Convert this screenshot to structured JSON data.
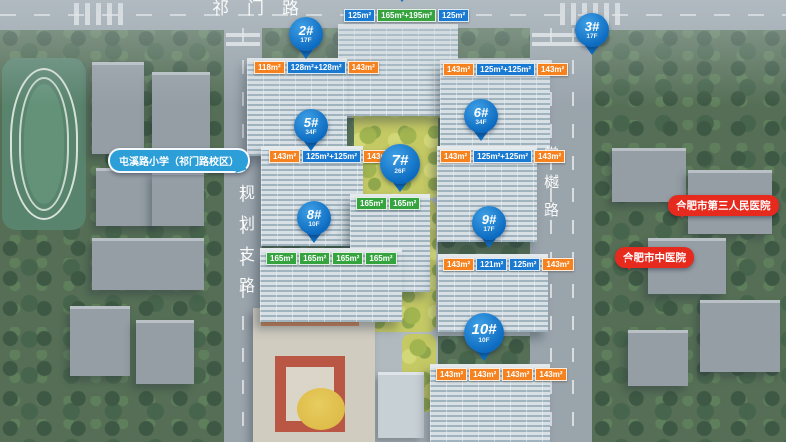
{
  "scene": {
    "type": "residential-masterplan-aerial-render"
  },
  "map": {
    "roads": {
      "top": "祁门路",
      "left": "规划支路",
      "right": "棠樾路"
    },
    "pins": [
      {
        "id": "top-partial",
        "label": "",
        "floors": "",
        "x": 402,
        "y": -40,
        "size": ""
      },
      {
        "id": "2",
        "label": "2#",
        "floors": "17F",
        "x": 306,
        "y": 17,
        "size": ""
      },
      {
        "id": "3",
        "label": "3#",
        "floors": "17F",
        "x": 592,
        "y": 13,
        "size": ""
      },
      {
        "id": "5",
        "label": "5#",
        "floors": "34F",
        "x": 311,
        "y": 109,
        "size": ""
      },
      {
        "id": "6",
        "label": "6#",
        "floors": "34F",
        "x": 481,
        "y": 99,
        "size": ""
      },
      {
        "id": "7",
        "label": "7#",
        "floors": "26F",
        "x": 400,
        "y": 144,
        "size": "lg"
      },
      {
        "id": "8",
        "label": "8#",
        "floors": "10F",
        "x": 314,
        "y": 201,
        "size": ""
      },
      {
        "id": "9",
        "label": "9#",
        "floors": "17F",
        "x": 489,
        "y": 206,
        "size": ""
      },
      {
        "id": "10",
        "label": "10#",
        "floors": "10F",
        "x": 484,
        "y": 313,
        "size": "lg"
      }
    ],
    "tag_rows": [
      {
        "building": "1",
        "x": 344,
        "y": 9,
        "tags": [
          {
            "t": "125m²",
            "c": "blue"
          },
          {
            "t": "165m²+195m²",
            "c": "green"
          },
          {
            "t": "125m²",
            "c": "blue"
          }
        ]
      },
      {
        "building": "2",
        "x": 254,
        "y": 61,
        "tags": [
          {
            "t": "118m²",
            "c": "orange"
          },
          {
            "t": "128m²+128m²",
            "c": "blue"
          },
          {
            "t": "143m²",
            "c": "orange"
          }
        ]
      },
      {
        "building": "3",
        "x": 443,
        "y": 63,
        "tags": [
          {
            "t": "143m²",
            "c": "orange"
          },
          {
            "t": "125m²+125m²",
            "c": "blue"
          },
          {
            "t": "143m²",
            "c": "orange"
          }
        ]
      },
      {
        "building": "5",
        "x": 269,
        "y": 150,
        "tags": [
          {
            "t": "143m²",
            "c": "orange"
          },
          {
            "t": "125m²+125m²",
            "c": "blue"
          },
          {
            "t": "143m²",
            "c": "orange"
          }
        ]
      },
      {
        "building": "6",
        "x": 440,
        "y": 150,
        "tags": [
          {
            "t": "143m²",
            "c": "orange"
          },
          {
            "t": "125m²+125m²",
            "c": "blue"
          },
          {
            "t": "143m²",
            "c": "orange"
          }
        ]
      },
      {
        "building": "7",
        "x": 356,
        "y": 197,
        "tags": [
          {
            "t": "165m²",
            "c": "green"
          },
          {
            "t": "165m²",
            "c": "green"
          }
        ]
      },
      {
        "building": "8",
        "x": 266,
        "y": 252,
        "tags": [
          {
            "t": "165m²",
            "c": "green"
          },
          {
            "t": "165m²",
            "c": "green"
          },
          {
            "t": "165m²",
            "c": "green"
          },
          {
            "t": "165m²",
            "c": "green"
          }
        ]
      },
      {
        "building": "9",
        "x": 443,
        "y": 258,
        "tags": [
          {
            "t": "143m²",
            "c": "orange"
          },
          {
            "t": "121m²",
            "c": "blue"
          },
          {
            "t": "125m²",
            "c": "blue"
          },
          {
            "t": "143m²",
            "c": "orange"
          }
        ]
      },
      {
        "building": "10",
        "x": 436,
        "y": 368,
        "tags": [
          {
            "t": "143m²",
            "c": "orange"
          },
          {
            "t": "143m²",
            "c": "orange"
          },
          {
            "t": "143m²",
            "c": "orange"
          },
          {
            "t": "143m²",
            "c": "orange"
          }
        ]
      }
    ],
    "poi": [
      {
        "id": "school",
        "label": "屯溪路小学（祁门路校区）",
        "x": 108,
        "y": 148,
        "style": "school"
      },
      {
        "id": "hospital-3rd",
        "label": "合肥市第三人民医院",
        "x": 668,
        "y": 195,
        "style": "hospital"
      },
      {
        "id": "hospital-tcm",
        "label": "合肥市中医院",
        "x": 615,
        "y": 247,
        "style": "hospital"
      }
    ],
    "colors": {
      "pin": "#1583d6",
      "tag_blue": "#1a7ad2",
      "tag_orange": "#f5821f",
      "tag_green": "#35a43f",
      "school": "#2d9fd8",
      "hospital": "#e62a1e"
    }
  }
}
